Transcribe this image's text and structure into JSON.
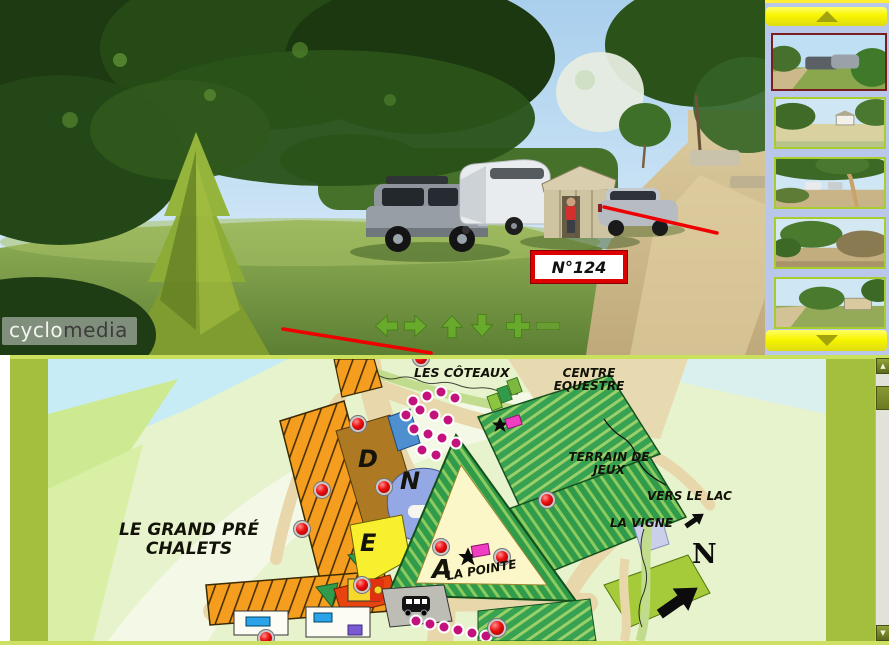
{
  "viewer": {
    "pitch_label": "N°124",
    "watermark": {
      "light": "cyclo",
      "dark": "media"
    },
    "nav_icons": [
      "pan-left",
      "pan-right",
      "pan-up",
      "pan-down",
      "zoom-in",
      "zoom-out"
    ]
  },
  "sidebar": {
    "thumbnail_count": 5,
    "selected_index": 1,
    "scroll_icons": [
      "scroll-up",
      "scroll-down"
    ]
  },
  "map": {
    "area_labels": {
      "grand_pre": "LE GRAND PRÉ CHALETS",
      "coteaux": "LES CÔTEAUX",
      "centre_equestre": "CENTRE EQUESTRE",
      "terrain_jeux": "TERRAIN DE JEUX",
      "vers_le_lac": "VERS LE LAC",
      "la_vigne": "LA VIGNE",
      "la_pointe": "LA POINTE"
    },
    "zone_letters": {
      "d": "D",
      "n": "N",
      "e": "E",
      "a": "A"
    },
    "compass": "N"
  },
  "colors": {
    "selected_thumb_border": "#7b1d1d",
    "thumb_border": "#a9cd2d",
    "scroll_button_yellow": "#f8f500",
    "map_frame_olive": "#a4bf3e",
    "marker_red": "#e00000",
    "dot_magenta": "#c3127b",
    "annotation_red": "#ee0000",
    "nav_arrow_green": "#69b02a"
  }
}
